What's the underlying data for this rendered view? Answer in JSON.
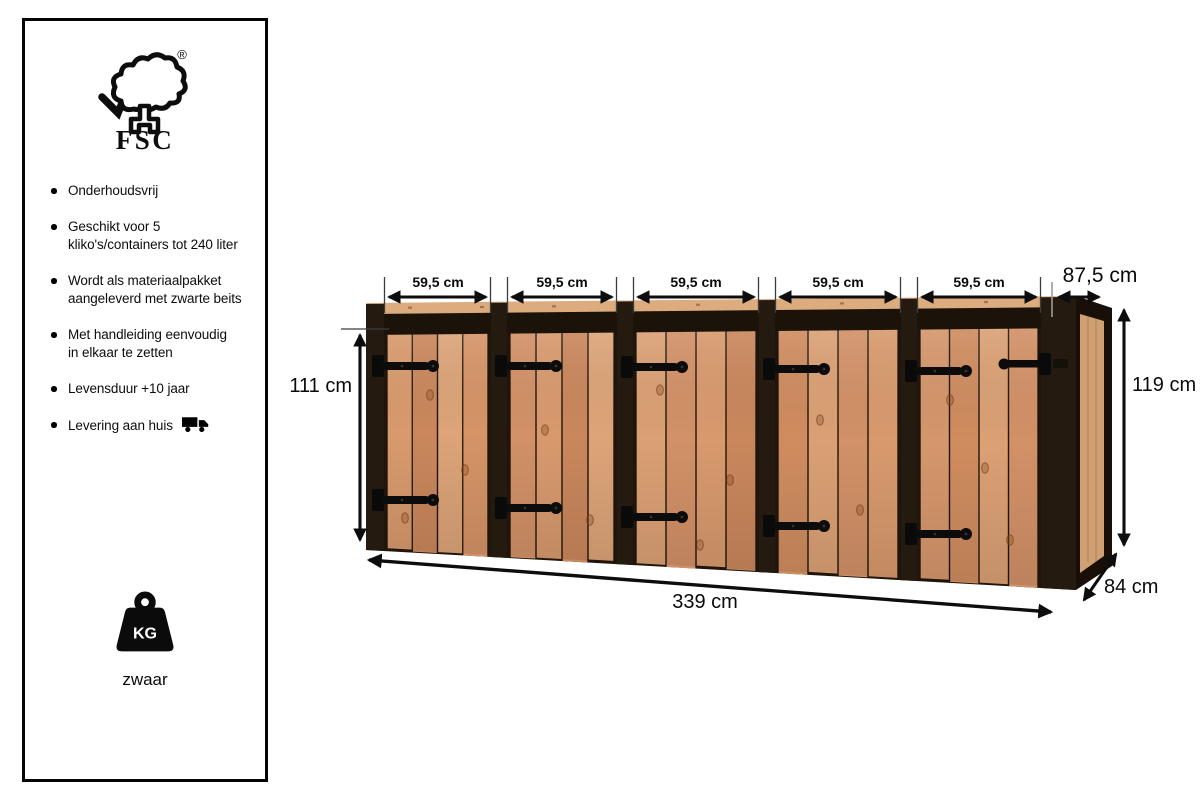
{
  "sidebar": {
    "fsc": {
      "label": "FSC",
      "registered": "®"
    },
    "features": [
      {
        "text": "Onderhoudsvrij"
      },
      {
        "text": "Geschikt voor 5\nkliko's/containers tot 240 liter"
      },
      {
        "text": "Wordt als materiaalpakket\naangeleverd met zwarte beits"
      },
      {
        "text": "Met handleiding eenvoudig\nin elkaar te zetten"
      },
      {
        "text": "Levensduur +10 jaar"
      },
      {
        "text": "Levering aan huis",
        "icon": "truck-icon"
      }
    ],
    "weight": {
      "unit": "KG",
      "label": "zwaar",
      "icon": "weight-icon"
    }
  },
  "diagram": {
    "bay_widths": [
      "59,5 cm",
      "59,5 cm",
      "59,5 cm",
      "59,5 cm",
      "59,5 cm"
    ],
    "top_depth": "87,5 cm",
    "door_height": "111 cm",
    "total_height": "119 cm",
    "total_width": "339 cm",
    "depth": "84 cm",
    "colors": {
      "wood": "#d79a6e",
      "wood_dark": "#c98659",
      "frame_black": "#20160d",
      "dimension_ink": "#0d0d0d"
    }
  }
}
